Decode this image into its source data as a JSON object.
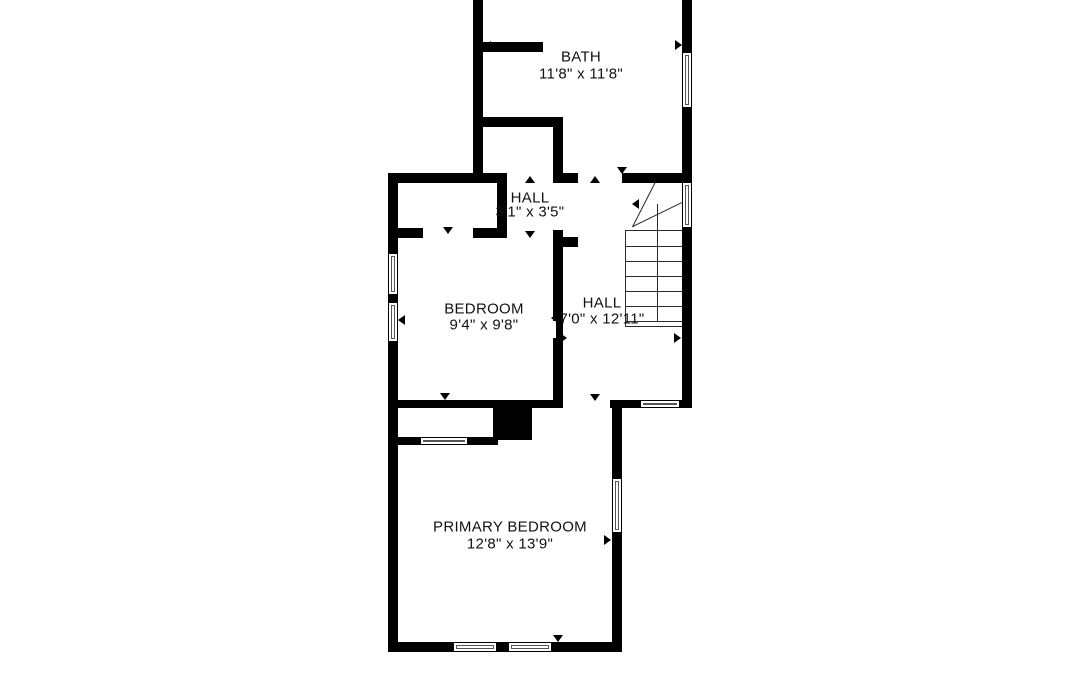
{
  "floor_plan": {
    "background_color": "#ffffff",
    "wall_color": "#000000",
    "stair_line_color": "#2a2a2a",
    "text_color": "#111111",
    "rooms": [
      {
        "id": "bath",
        "name": "BATH",
        "dims": "11'8\" x 11'8\"",
        "cx": 581,
        "name_y": 57,
        "dims_y": 74
      },
      {
        "id": "hall-small",
        "name": "HALL",
        "dims": "3'1\" x 3'5\"",
        "cx": 530,
        "name_y": 198,
        "dims_y": 212
      },
      {
        "id": "bedroom",
        "name": "BEDROOM",
        "dims": "9'4\" x 9'8\"",
        "cx": 484,
        "name_y": 309,
        "dims_y": 325
      },
      {
        "id": "hall",
        "name": "HALL",
        "dims": "7'0\" x 12'11\"",
        "cx": 602,
        "name_y": 303,
        "dims_y": 319
      },
      {
        "id": "primary-bedroom",
        "name": "PRIMARY BEDROOM",
        "dims": "12'8\" x 13'9\"",
        "cx": 510,
        "name_y": 527,
        "dims_y": 544
      }
    ],
    "geometry": {
      "walls": [
        {
          "x": 473,
          "y": 0,
          "w": 10,
          "h": 183
        },
        {
          "x": 682,
          "y": 0,
          "w": 10,
          "h": 52
        },
        {
          "x": 682,
          "y": 108,
          "w": 10,
          "h": 75
        },
        {
          "x": 478,
          "y": 42,
          "w": 65,
          "h": 10
        },
        {
          "x": 473,
          "y": 117,
          "w": 90,
          "h": 10
        },
        {
          "x": 553,
          "y": 127,
          "w": 10,
          "h": 56
        },
        {
          "x": 388,
          "y": 173,
          "w": 119,
          "h": 10
        },
        {
          "x": 553,
          "y": 173,
          "w": 25,
          "h": 10
        },
        {
          "x": 622,
          "y": 173,
          "w": 65,
          "h": 10
        },
        {
          "x": 497,
          "y": 183,
          "w": 10,
          "h": 55
        },
        {
          "x": 388,
          "y": 228,
          "w": 35,
          "h": 10
        },
        {
          "x": 473,
          "y": 228,
          "w": 34,
          "h": 10
        },
        {
          "x": 553,
          "y": 230,
          "w": 10,
          "h": 91
        },
        {
          "x": 563,
          "y": 237,
          "w": 15,
          "h": 10
        },
        {
          "x": 556,
          "y": 321,
          "w": 7,
          "h": 17
        },
        {
          "x": 553,
          "y": 338,
          "w": 10,
          "h": 62
        },
        {
          "x": 388,
          "y": 173,
          "w": 10,
          "h": 80
        },
        {
          "x": 388,
          "y": 295,
          "w": 10,
          "h": 7
        },
        {
          "x": 388,
          "y": 342,
          "w": 10,
          "h": 310
        },
        {
          "x": 388,
          "y": 400,
          "w": 175,
          "h": 8
        },
        {
          "x": 493,
          "y": 408,
          "w": 39,
          "h": 32
        },
        {
          "x": 393,
          "y": 437,
          "w": 27,
          "h": 8
        },
        {
          "x": 468,
          "y": 437,
          "w": 30,
          "h": 8
        },
        {
          "x": 610,
          "y": 400,
          "w": 30,
          "h": 8
        },
        {
          "x": 680,
          "y": 400,
          "w": 12,
          "h": 8
        },
        {
          "x": 612,
          "y": 408,
          "w": 10,
          "h": 70
        },
        {
          "x": 612,
          "y": 533,
          "w": 10,
          "h": 119
        },
        {
          "x": 388,
          "y": 642,
          "w": 65,
          "h": 10
        },
        {
          "x": 497,
          "y": 642,
          "w": 11,
          "h": 10
        },
        {
          "x": 552,
          "y": 642,
          "w": 70,
          "h": 10
        },
        {
          "x": 682,
          "y": 228,
          "w": 10,
          "h": 180
        }
      ],
      "windows": [
        {
          "x": 682,
          "y": 52,
          "w": 10,
          "h": 56
        },
        {
          "x": 682,
          "y": 182,
          "w": 10,
          "h": 46
        },
        {
          "x": 388,
          "y": 253,
          "w": 10,
          "h": 42
        },
        {
          "x": 388,
          "y": 302,
          "w": 10,
          "h": 40
        },
        {
          "x": 612,
          "y": 478,
          "w": 10,
          "h": 55
        },
        {
          "x": 420,
          "y": 437,
          "w": 48,
          "h": 8
        },
        {
          "x": 640,
          "y": 400,
          "w": 40,
          "h": 8
        },
        {
          "x": 453,
          "y": 642,
          "w": 44,
          "h": 10
        },
        {
          "x": 508,
          "y": 642,
          "w": 44,
          "h": 10
        }
      ],
      "door_markers": [
        {
          "x": 484,
          "y": 46,
          "d": "left"
        },
        {
          "x": 682,
          "y": 45,
          "d": "right"
        },
        {
          "x": 530,
          "y": 176,
          "d": "up"
        },
        {
          "x": 530,
          "y": 238,
          "d": "down"
        },
        {
          "x": 448,
          "y": 234,
          "d": "down"
        },
        {
          "x": 595,
          "y": 176,
          "d": "up"
        },
        {
          "x": 622,
          "y": 174,
          "d": "down"
        },
        {
          "x": 551,
          "y": 318,
          "d": "left"
        },
        {
          "x": 567,
          "y": 338,
          "d": "right"
        },
        {
          "x": 595,
          "y": 401,
          "d": "down"
        },
        {
          "x": 681,
          "y": 338,
          "d": "right"
        },
        {
          "x": 445,
          "y": 400,
          "d": "down"
        },
        {
          "x": 558,
          "y": 642,
          "d": "down"
        },
        {
          "x": 611,
          "y": 540,
          "d": "right"
        },
        {
          "x": 398,
          "y": 320,
          "d": "left"
        }
      ],
      "stairs": {
        "box": {
          "x": 625,
          "y": 230,
          "w": 58,
          "h": 97
        },
        "tread_ys": [
          246,
          261,
          276,
          291,
          306,
          321
        ],
        "center_line": {
          "x": 657,
          "y1": 204,
          "y2": 322
        },
        "diagonals": [
          {
            "x1": 657,
            "y1": 180,
            "x2": 633,
            "y2": 227
          },
          {
            "x1": 682,
            "y1": 203,
            "x2": 633,
            "y2": 227
          }
        ],
        "arrow_tip": {
          "x": 632,
          "y": 204,
          "d": "left"
        }
      }
    }
  }
}
